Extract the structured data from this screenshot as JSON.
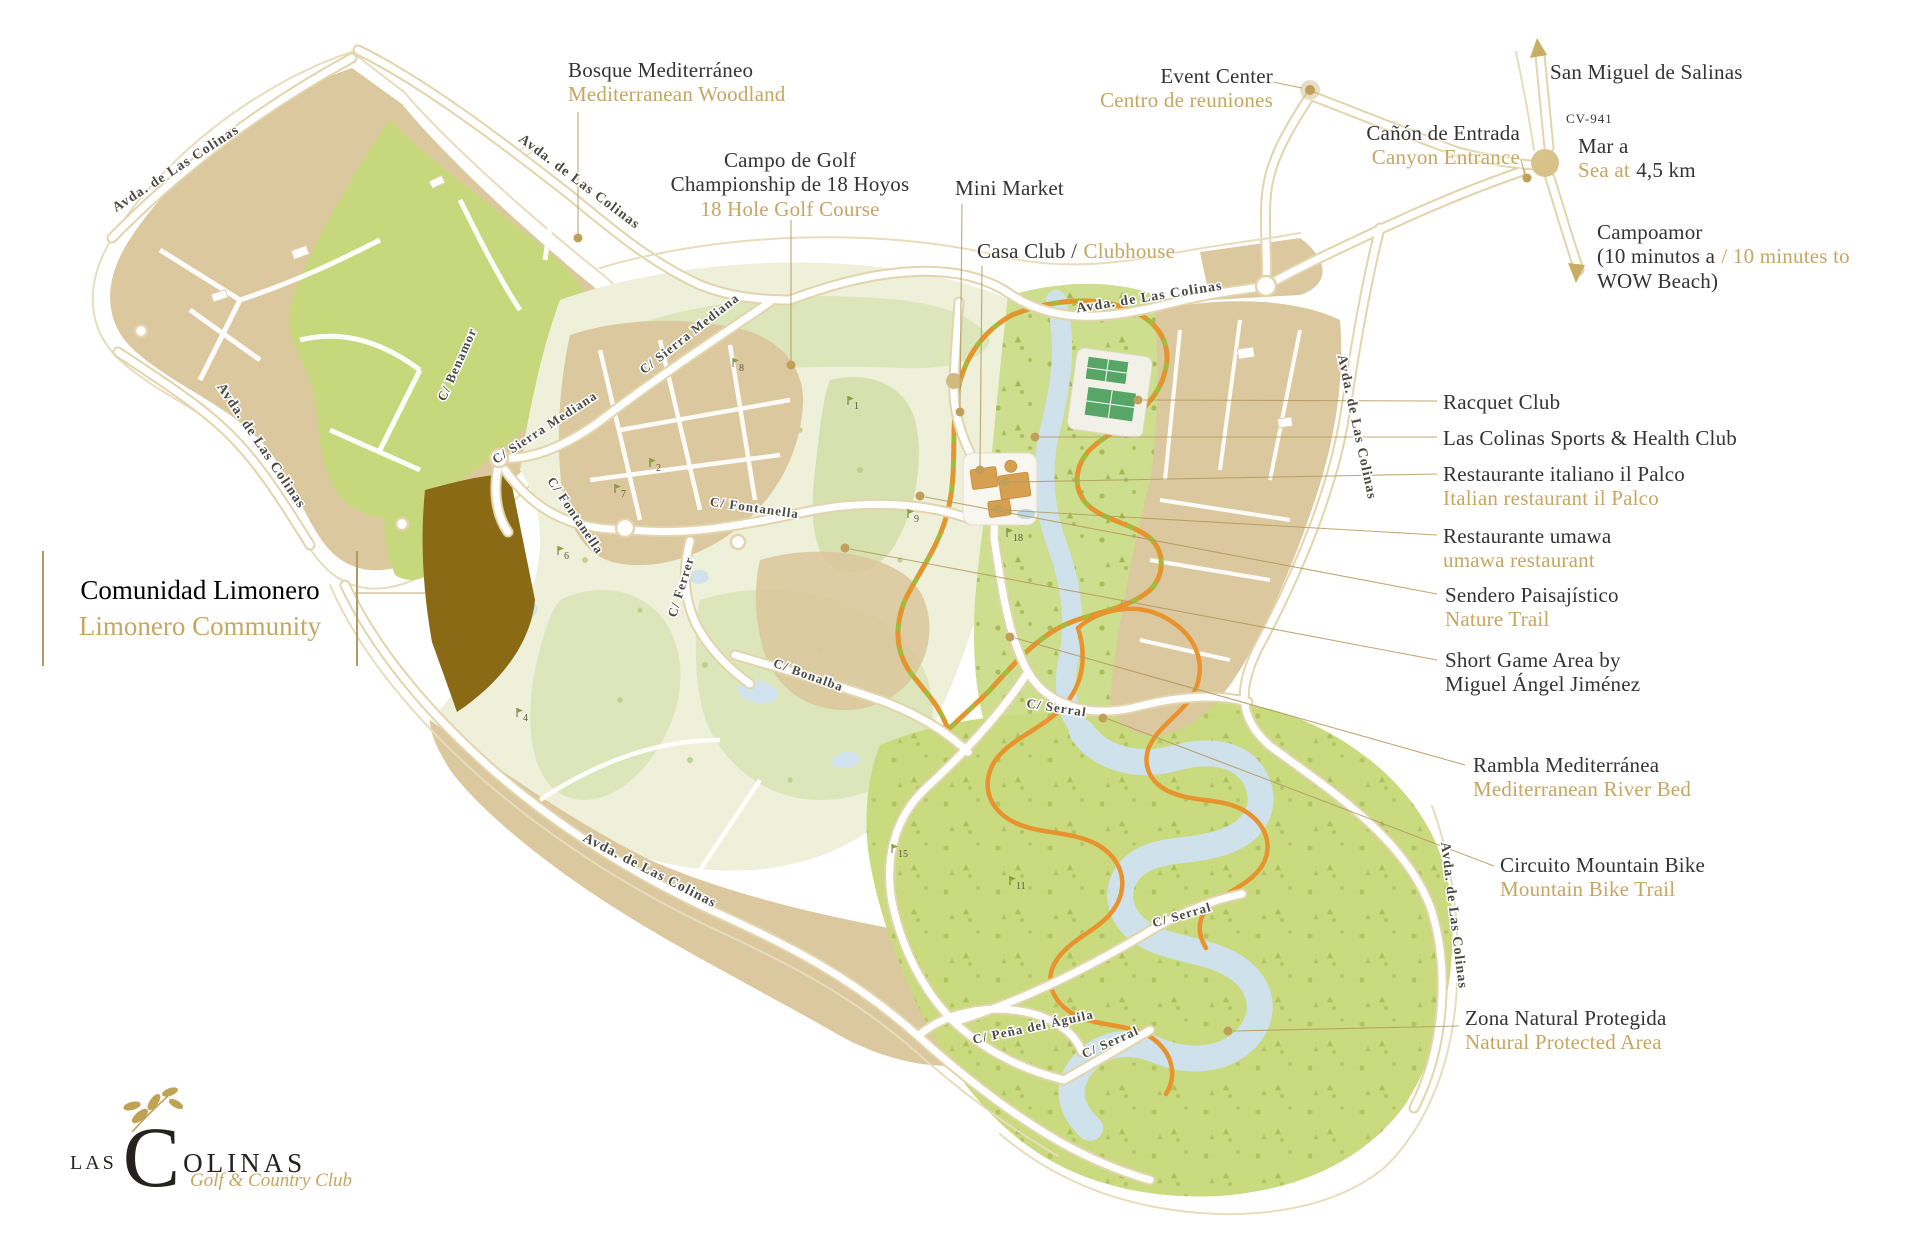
{
  "colors": {
    "gold_text": "#c7a661",
    "ink_text": "#343434",
    "leader": "#b59a5f",
    "parcel_beige": "#dcc89e",
    "woodland_green": "#c6d77c",
    "golf_pale": "#eef0da",
    "fairway": "#dde6ba",
    "protected_green": "#cbdb80",
    "river_blue": "#cfe1ea",
    "limonero_parcel": "#8a6a14",
    "nature_trail_green": "#a6ba3a",
    "trail_orange": "#e8932e",
    "road_casing": "#e2d4ac"
  },
  "labels": {
    "bosque": {
      "main": "Bosque Mediterráneo",
      "sub": "Mediterranean Woodland"
    },
    "campo": {
      "line1": "Campo de Golf",
      "line2": "Championship de 18 Hoyos",
      "sub": "18 Hole Golf Course"
    },
    "mini_market": {
      "main": "Mini Market"
    },
    "casa_club": {
      "main": "Casa Club /",
      "sub": "Clubhouse"
    },
    "event_center": {
      "main": "Event Center",
      "sub": "Centro de reuniones"
    },
    "canon": {
      "main": "Cañón de Entrada",
      "sub": "Canyon Entrance"
    },
    "san_miguel": {
      "main": "San Miguel de Salinas"
    },
    "cv941": {
      "main": "CV-941"
    },
    "mar": {
      "main": "Mar a",
      "sub": "Sea at",
      "value": "4,5 km"
    },
    "campoamor": {
      "line1": "Campoamor",
      "line2_es": "(10 minutos a",
      "line2_en": "/ 10 minutes to",
      "line3": "WOW Beach)"
    },
    "racquet": {
      "main": "Racquet Club"
    },
    "sports": {
      "main": "Las Colinas Sports & Health Club"
    },
    "palco": {
      "main": "Restaurante italiano il Palco",
      "sub": "Italian restaurant il Palco"
    },
    "umawa": {
      "main": "Restaurante umawa",
      "sub": "umawa restaurant"
    },
    "sendero": {
      "main": "Sendero Paisajístico",
      "sub": "Nature Trail"
    },
    "short_game": {
      "line1": "Short Game Area by",
      "line2": "Miguel Ángel Jiménez"
    },
    "rambla": {
      "main": "Rambla Mediterránea",
      "sub": "Mediterranean River Bed"
    },
    "circuito": {
      "main": "Circuito Mountain Bike",
      "sub": "Mountain Bike Trail"
    },
    "zona": {
      "main": "Zona Natural Protegida",
      "sub": "Natural Protected Area"
    },
    "limonero": {
      "main": "Comunidad Limonero",
      "sub": "Limonero Community"
    }
  },
  "streets": {
    "avda": "Avda. de Las Colinas",
    "benamor": "C/ Benamor",
    "sierra_mediana": "C/ Sierra Mediana",
    "fontanella": "C/ Fontanella",
    "ferrer": "C/ Ferrer",
    "bonalba": "C/ Bonalba",
    "serral": "C/ Serral",
    "pena_aguila": "C/ Peña del Águila"
  },
  "holes": [
    "1",
    "2",
    "4",
    "6",
    "7",
    "8",
    "9",
    "11",
    "15",
    "18"
  ],
  "logo": {
    "word_start": "LAS",
    "initial": "C",
    "word_end": "OLINAS",
    "tagline": "Golf & Country Club"
  }
}
